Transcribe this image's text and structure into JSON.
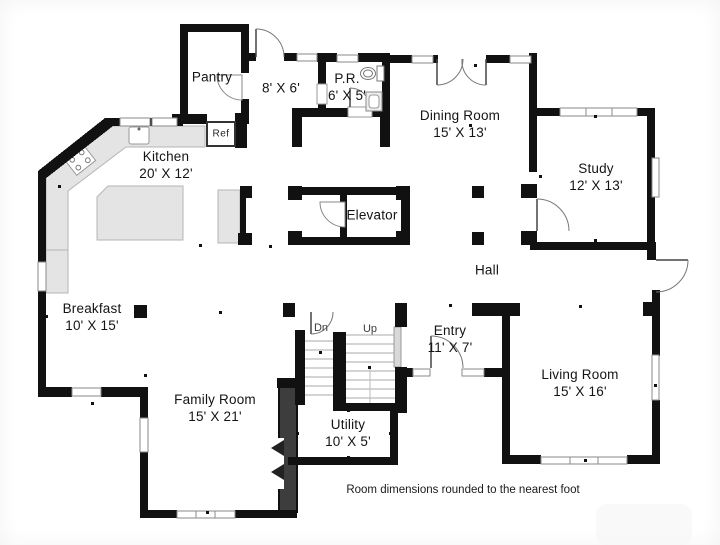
{
  "plan": {
    "footnote": "Room dimensions rounded to the nearest foot",
    "rooms": {
      "pantry": {
        "name": "Pantry",
        "dims": ""
      },
      "mudroom": {
        "name": "",
        "dims": "8' X 6'"
      },
      "powder_room": {
        "name": "P.R.",
        "dims": "6' X 5'"
      },
      "dining_room": {
        "name": "Dining Room",
        "dims": "15' X 13'"
      },
      "study": {
        "name": "Study",
        "dims": "12' X 13'"
      },
      "kitchen": {
        "name": "Kitchen",
        "dims": "20' X 12'"
      },
      "elevator": {
        "name": "Elevator",
        "dims": ""
      },
      "hall": {
        "name": "Hall",
        "dims": ""
      },
      "breakfast": {
        "name": "Breakfast",
        "dims": "10' X 15'"
      },
      "entry": {
        "name": "Entry",
        "dims": "11' X 7'"
      },
      "family_room": {
        "name": "Family Room",
        "dims": "15' X 21'"
      },
      "utility": {
        "name": "Utility",
        "dims": "10' X 5'"
      },
      "living_room": {
        "name": "Living Room",
        "dims": "15' X 16'"
      }
    },
    "stairs": {
      "down": "Dn",
      "up": "Up"
    },
    "labels": {
      "refrigerator": "Ref"
    },
    "colors": {
      "wall": "#111111",
      "counter": "#e4e4e4",
      "counter_border": "#b5b5b5",
      "chimney": "#3d3d3d",
      "window_border": "#8a8a8a"
    }
  }
}
